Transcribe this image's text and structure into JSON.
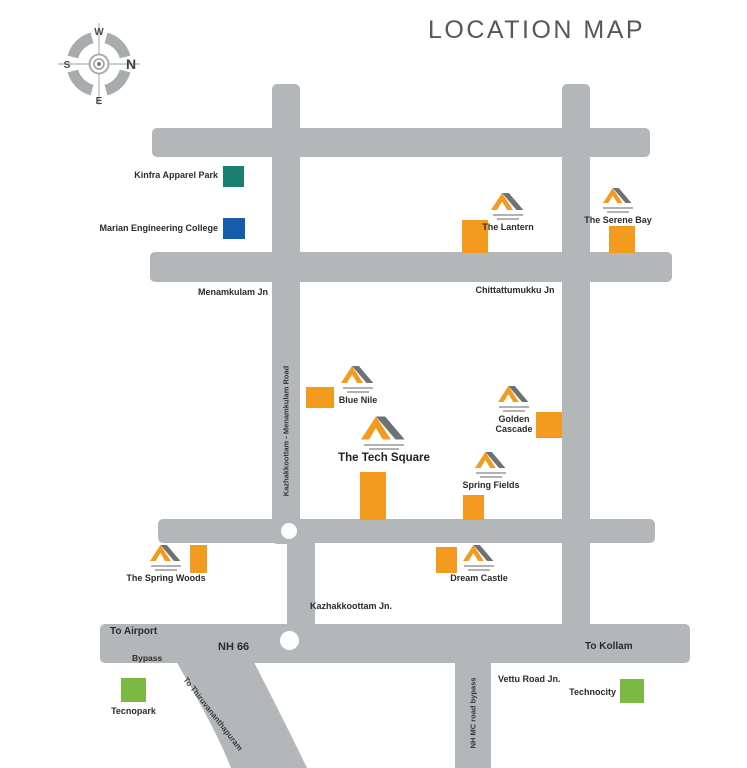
{
  "title": "LOCATION MAP",
  "compass": {
    "north": "N",
    "south": "S",
    "east": "E",
    "west": "W"
  },
  "colors": {
    "road": "#b4b7b9",
    "project_marker": "#f49a1f",
    "kinfra_swatch": "#19806f",
    "marian_swatch": "#155cab",
    "technopark_swatch": "#7cb942",
    "title_text": "#55575a"
  },
  "junctions": {
    "menamkulam": "Menamkulam Jn",
    "chittattumukku": "Chittattumukku Jn",
    "kazhakkoottam": "Kazhakkoottam Jn.",
    "vettu_road": "Vettu Road Jn."
  },
  "road_labels": {
    "nh66": "NH 66",
    "bypass": "Bypass",
    "to_airport": "To Airport",
    "to_kollam": "To Kollam",
    "to_thiruvananthapuram": "To Thiruvananthapuram",
    "kazhakkoottam_menamkulam_road": "Kazhakkoottam - Menamkulam Road",
    "nh_mc_road_bypass": "NH MC road bypass"
  },
  "landmarks": {
    "kinfra": {
      "name": "Kinfra Apparel Park",
      "color": "#19806f"
    },
    "marian": {
      "name": "Marian Engineering College",
      "color": "#155cab"
    },
    "tecnopark": {
      "name": "Tecnopark",
      "color": "#7cb942"
    },
    "technocity": {
      "name": "Technocity",
      "color": "#7cb942"
    }
  },
  "projects": {
    "lantern": {
      "name": "The Lantern"
    },
    "serene_bay": {
      "name": "The Serene Bay"
    },
    "blue_nile": {
      "name": "Blue Nile"
    },
    "golden_cascade": {
      "name": "Golden Cascade"
    },
    "tech_square": {
      "name": "The Tech Square"
    },
    "spring_fields": {
      "name": "Spring Fields"
    },
    "spring_woods": {
      "name": "The Spring Woods"
    },
    "dream_castle": {
      "name": "Dream Castle"
    }
  }
}
